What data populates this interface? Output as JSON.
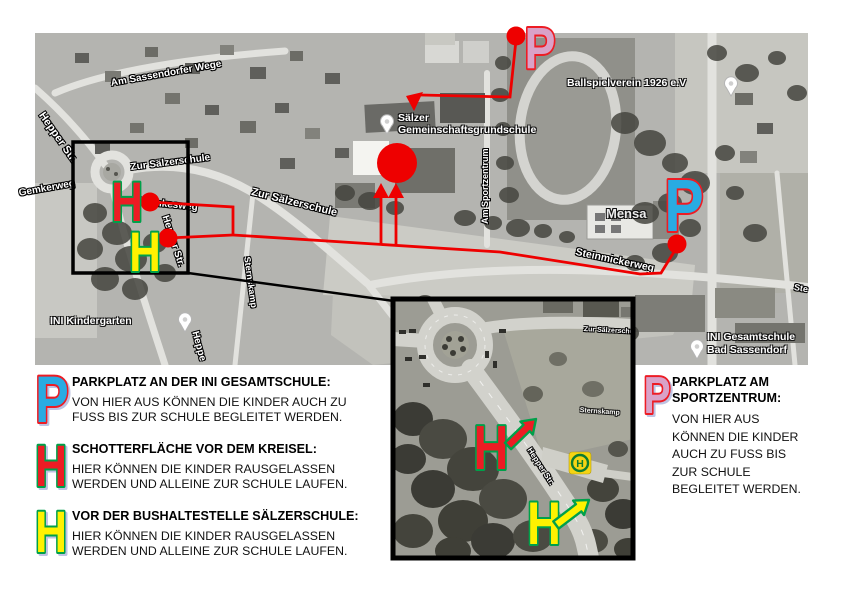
{
  "colors": {
    "route_red": "#ee0000",
    "marker_red": "#ED1C24",
    "marker_yellow": "#FFF200",
    "marker_cyan": "#29ABE2",
    "marker_pink": "#D9A2C8",
    "outline_green": "#00A04A",
    "outline_red": "#ED1C24",
    "bus_green": "#0e7c30",
    "bus_yellow": "#f5d413"
  },
  "map": {
    "streets": {
      "am_sassendorfer_wege": "Am Sassendorfer Wege",
      "hepper_str": "Hepper Str.",
      "gemkerweg": "Gemkerweg",
      "zur_saelzerschule_1": "Zur Sälzerschule",
      "zur_saelzerschule_2": "Zur Sälzerschule",
      "stemkesweg": "Stemkesweg",
      "hepper_str_vert": "Hepper Str.",
      "sternskamp": "Sternskamp",
      "heppe_cut": "Heppe",
      "am_sportzentrum": "Am Sportzentrum",
      "steinmickerweg": "Steinmickerweg",
      "ste_cut": "Ste"
    },
    "poi": {
      "school_line1": "Sälzer",
      "school_line2": "Gemeinschaftsgrundschule",
      "ballspielverein": "Ballspielverein 1926 e.V",
      "mensa": "Mensa",
      "kindergarten": "INI Kindergarten",
      "gesamtschule_line1": "INI Gesamtschule",
      "gesamtschule_line2": "Bad Sassendorf"
    },
    "markers": {
      "h_red": "H",
      "h_yellow": "H",
      "p_top": "P",
      "p_right": "P"
    }
  },
  "inset": {
    "markers": {
      "h_red": "H",
      "h_yellow": "H"
    },
    "bus_label": "H",
    "streets": {
      "hepper_str": "Hepper Str.",
      "zur_saelzerschule": "Zur Sälzerschu",
      "sternskamp": "Sternskamp"
    }
  },
  "legend": {
    "left": [
      {
        "symbol": "P",
        "title": "PARKPLATZ AN DER INI GESAMTSCHULE:",
        "body": "VON HIER AUS KÖNNEN DIE KINDER AUCH ZU FUSS BIS ZUR SCHULE BEGLEITET WERDEN."
      },
      {
        "symbol": "H",
        "title": "SCHOTTERFLÄCHE VOR DEM KREISEL:",
        "body": "HIER KÖNNEN DIE KINDER RAUSGELASSEN WERDEN UND ALLEINE ZUR SCHULE LAUFEN."
      },
      {
        "symbol": "H",
        "title": "VOR DER BUSHALTESTELLE SÄLZERSCHULE:",
        "body": "HIER KÖNNEN DIE KINDER RAUSGELASSEN WERDEN UND ALLEINE ZUR SCHULE LAUFEN."
      }
    ],
    "right": {
      "symbol": "P",
      "title": "PARKPLATZ AM SPORTZENTRUM:",
      "body": "VON HIER AUS KÖNNEN DIE KINDER AUCH ZU FUSS BIS ZUR SCHULE BEGLEITET WERDEN."
    }
  }
}
